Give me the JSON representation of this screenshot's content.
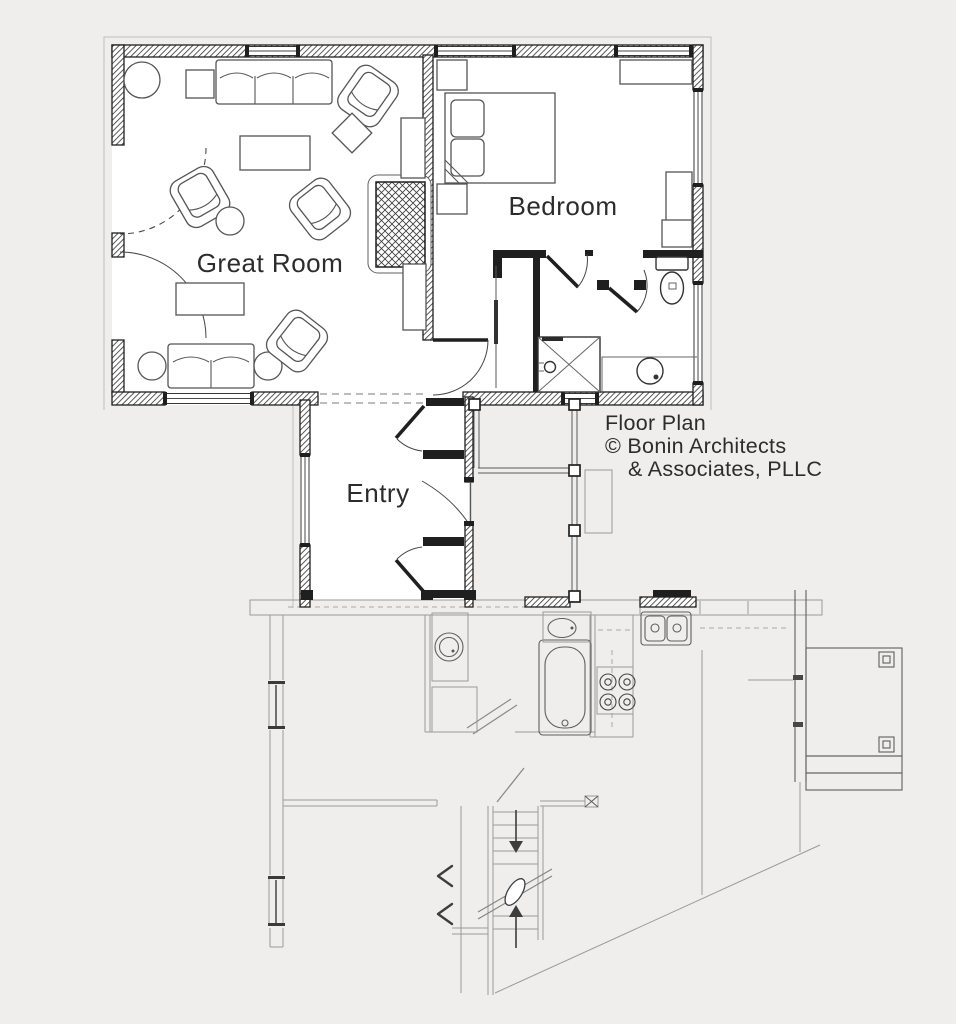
{
  "plan": {
    "labels": {
      "great_room": "Great Room",
      "bedroom": "Bedroom",
      "entry": "Entry"
    },
    "attribution": {
      "line1": "Floor Plan",
      "line2": "© Bonin Architects",
      "line3": "& Associates, PLLC"
    }
  },
  "colors": {
    "background": "#efeeed",
    "wall": "#1f1f1f",
    "furniture": "#555555",
    "fixture": "#333333",
    "lower_level": "#9a9a9a",
    "deck": "#5f5f5f",
    "text": "#2c2c2c",
    "room_fill": "#ffffff",
    "outline": "#bdbdbd"
  }
}
